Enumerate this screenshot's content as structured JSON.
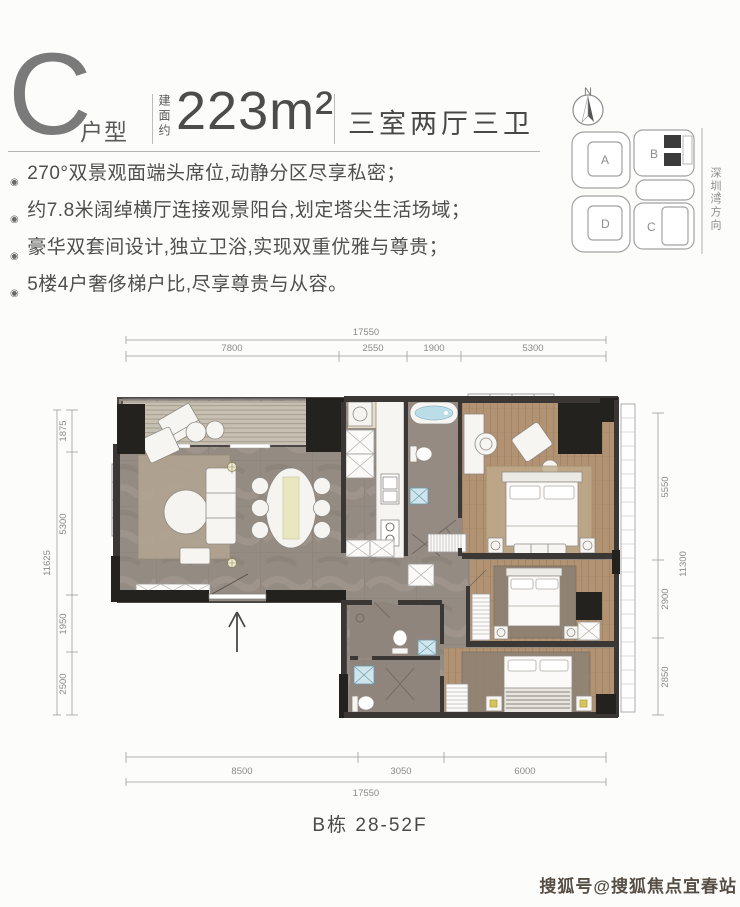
{
  "header": {
    "unit_letter": "C",
    "unit_label": "户型",
    "area_prefix": "建面约",
    "area_value": "223m²",
    "layout_type": "三室两厅三卫"
  },
  "features": [
    "270°双景观面端头席位,动静分区尽享私密；",
    "约7.8米阔绰横厅连接观景阳台,划定塔尖生活场域；",
    "豪华双套间设计,独立卫浴,实现双重优雅与尊贵；",
    "5楼4户奢侈梯户比,尽享尊贵与从容。"
  ],
  "site_map": {
    "north_label": "N",
    "blocks": [
      "A",
      "B",
      "C",
      "D"
    ],
    "direction_label": "深圳湾方向",
    "direction_arrow": "›"
  },
  "floor_plan": {
    "dims": {
      "top": {
        "total": "17550",
        "segments": [
          "7800",
          "2550",
          "1900",
          "5300"
        ]
      },
      "bottom": {
        "total": "17550",
        "segments": [
          "8500",
          "3050",
          "6000"
        ]
      },
      "left": {
        "total": "11625",
        "segments": [
          "1875",
          "5300",
          "1950",
          "2500"
        ]
      },
      "right": {
        "total": "11300",
        "segments": [
          "5550",
          "2900",
          "2850"
        ]
      }
    }
  },
  "footer": {
    "building_label": "B栋 28-52F"
  },
  "watermark": "搜狐号@搜狐焦点宜春站",
  "colors": {
    "wall": "#3a3734",
    "wall_black": "#23221f",
    "marble_floor": "#948b83",
    "wood_floor": "#b19273",
    "deck": "#c7bfb1",
    "tub_water": "#badde7",
    "rug_gray": "#8d8173",
    "lamp_yellow": "#d6c45e",
    "dim_line": "#9b9b9b",
    "dim_text": "#8a8a8a"
  }
}
